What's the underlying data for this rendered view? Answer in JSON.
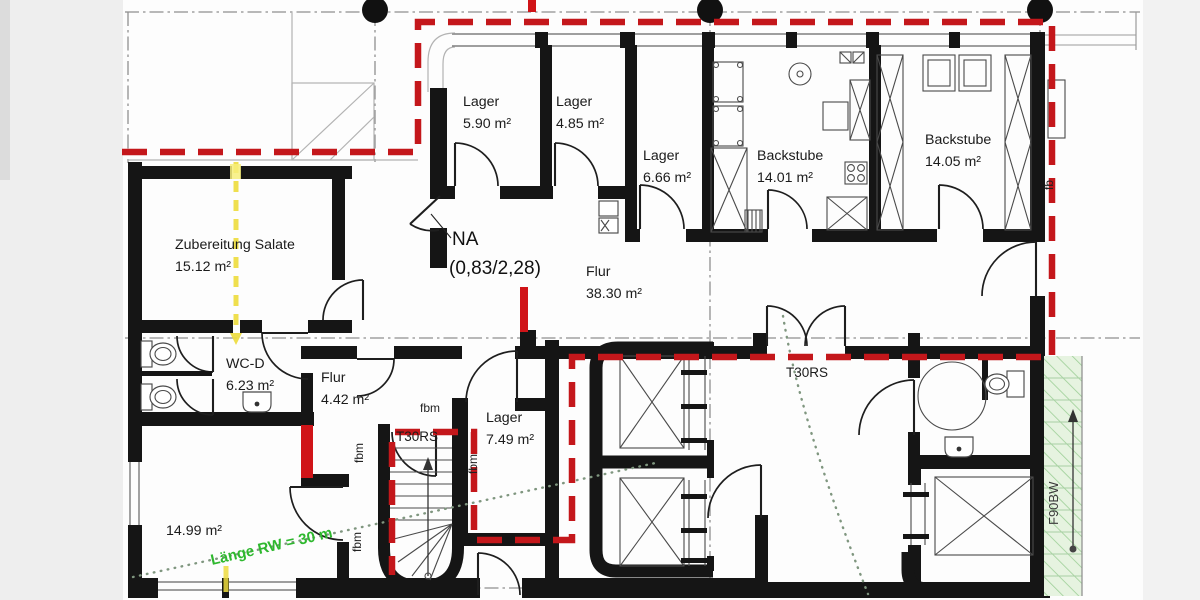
{
  "plan": {
    "rooms": {
      "lager_590": {
        "name": "Lager",
        "area": "5.90 m²"
      },
      "lager_485": {
        "name": "Lager",
        "area": "4.85 m²"
      },
      "lager_666": {
        "name": "Lager",
        "area": "6.66 m²"
      },
      "backstube_1401": {
        "name": "Backstube",
        "area": "14.01 m²"
      },
      "backstube_1405": {
        "name": "Backstube",
        "area": "14.05 m²"
      },
      "zubereitung": {
        "name": "Zubereitung Salate",
        "area": "15.12 m²"
      },
      "flur_3830": {
        "name": "Flur",
        "area": "38.30 m²"
      },
      "wc_d": {
        "name": "WC-D",
        "area": "6.23 m²"
      },
      "flur_442": {
        "name": "Flur",
        "area": "4.42 m²"
      },
      "lager_749": {
        "name": "Lager",
        "area": "7.49 m²"
      },
      "room_1499": {
        "area": "14.99 m²"
      }
    },
    "annotations": {
      "na_label": "NA",
      "na_dimension": "(0,83/2,28)",
      "t30rs": "T30RS",
      "fbm": "fbm",
      "fb": "fb",
      "f90bw": "F90BW",
      "rw_note": "Länge RW = 30 m"
    },
    "colors": {
      "wall": "#151515",
      "fire_boundary_red": "#c4171b",
      "highlight_yellow": "#eedc3f",
      "escape_route_green": "#2eb82e",
      "f90_hatch_green": "#9ccf96"
    }
  }
}
